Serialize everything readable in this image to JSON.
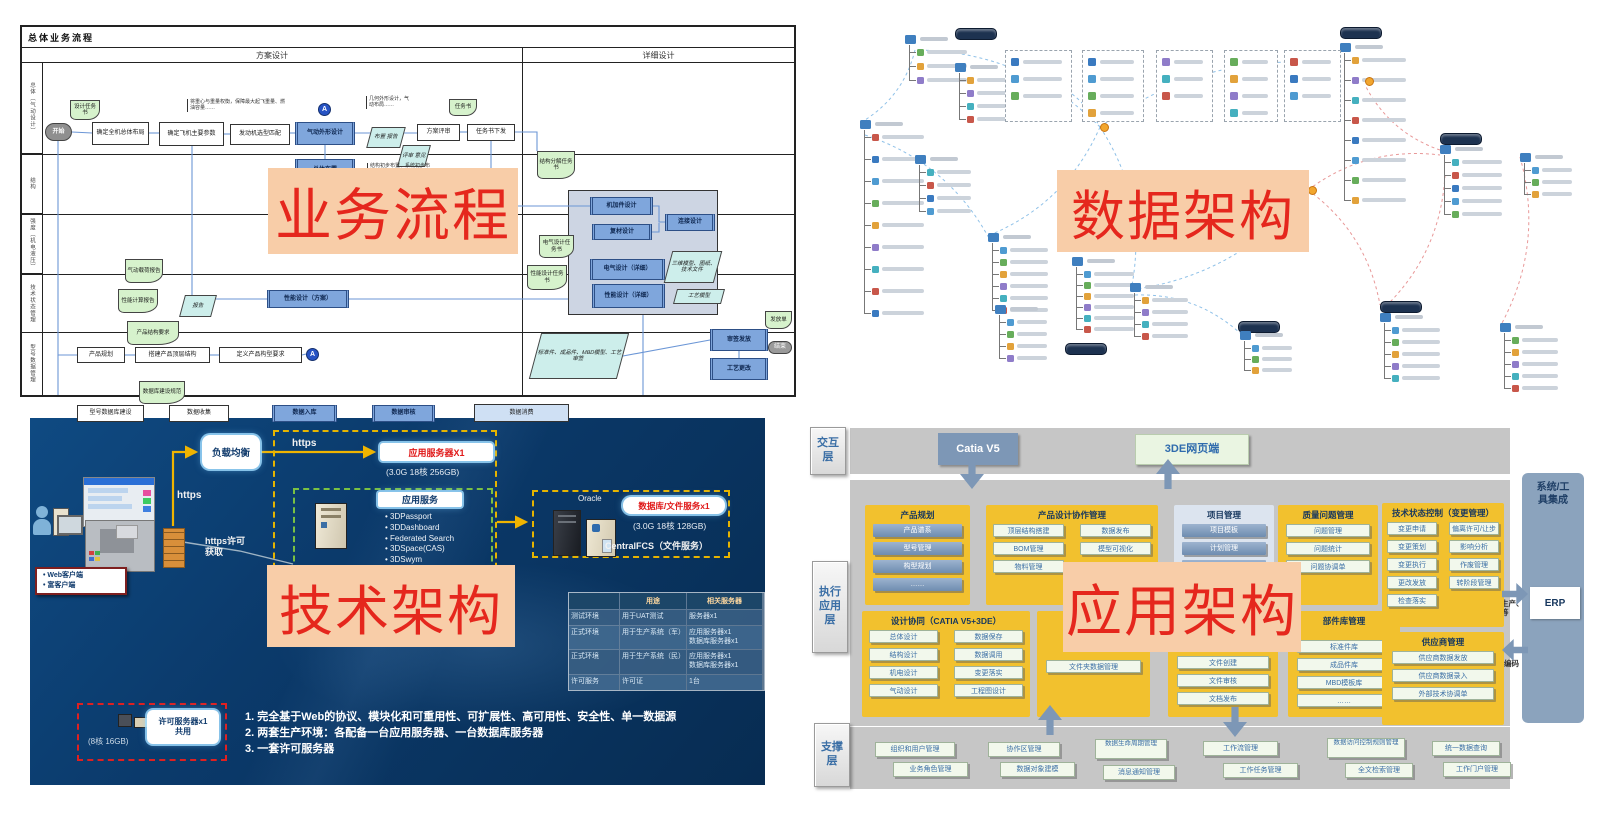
{
  "overlays": [
    {
      "id": "business-process",
      "label": "业务流程",
      "x": 268,
      "y": 168,
      "w": 250,
      "h": 86,
      "fs": 57
    },
    {
      "id": "data-architecture",
      "label": "数据架构",
      "x": 1057,
      "y": 170,
      "w": 252,
      "h": 82,
      "fs": 54
    },
    {
      "id": "tech-architecture",
      "label": "技术架构",
      "x": 267,
      "y": 565,
      "w": 248,
      "h": 82,
      "fs": 54
    },
    {
      "id": "app-architecture",
      "label": "应用架构",
      "x": 1063,
      "y": 562,
      "w": 238,
      "h": 90,
      "fs": 56
    }
  ],
  "tl": {
    "title": "总体业务流程",
    "phases": [
      "方案设计",
      "详细设计"
    ],
    "lanes": [
      "总体（气动设计）",
      "结构",
      "强度（机电液压）",
      "技术状态管理",
      "型号数据管理"
    ],
    "lane_heights": [
      91,
      60,
      60,
      58,
      63
    ],
    "nodes": [
      {
        "t": "panel",
        "x": 546,
        "y": 127,
        "w": 150,
        "h": 125,
        "s": ""
      },
      {
        "t": "doc",
        "x": 48,
        "y": 37,
        "w": 30,
        "h": 20,
        "s": "设计任务书"
      },
      {
        "t": "start",
        "x": 23,
        "y": 60,
        "w": 27,
        "h": 18,
        "s": "开始"
      },
      {
        "t": "box",
        "x": 70,
        "y": 59,
        "w": 57,
        "h": 23,
        "s": "确定全机总体布局"
      },
      {
        "t": "box",
        "x": 137,
        "y": 59,
        "w": 65,
        "h": 24,
        "s": "确定飞机主要参数"
      },
      {
        "t": "box",
        "x": 208,
        "y": 61,
        "w": 60,
        "h": 21,
        "s": "发动机选型匹配"
      },
      {
        "t": "blue",
        "x": 273,
        "y": 59,
        "w": 60,
        "h": 23,
        "s": "气动外形设计"
      },
      {
        "t": "circle",
        "x": 296,
        "y": 40,
        "w": 13,
        "h": 13,
        "s": "A"
      },
      {
        "t": "blue",
        "x": 273,
        "y": 96,
        "w": 60,
        "h": 22,
        "s": "总体布置"
      },
      {
        "t": "para",
        "x": 347,
        "y": 64,
        "w": 34,
        "h": 21,
        "s": "布置 报告"
      },
      {
        "t": "doc",
        "x": 427,
        "y": 36,
        "w": 28,
        "h": 17,
        "s": "任务书"
      },
      {
        "t": "box",
        "x": 395,
        "y": 61,
        "w": 43,
        "h": 17,
        "s": "方案评审"
      },
      {
        "t": "box",
        "x": 445,
        "y": 61,
        "w": 48,
        "h": 17,
        "s": "任务书下发"
      },
      {
        "t": "para",
        "x": 378,
        "y": 82,
        "w": 28,
        "h": 22,
        "s": "评审 意见"
      },
      {
        "t": "doc",
        "x": 515,
        "y": 88,
        "w": 38,
        "h": 28,
        "s": "结构分解任务书"
      },
      {
        "t": "blue",
        "x": 568,
        "y": 134,
        "w": 63,
        "h": 18,
        "s": "机加件设计"
      },
      {
        "t": "blue",
        "x": 570,
        "y": 161,
        "w": 60,
        "h": 16,
        "s": "复材设计"
      },
      {
        "t": "blue",
        "x": 643,
        "y": 151,
        "w": 50,
        "h": 17,
        "s": "连接设计"
      },
      {
        "t": "blue",
        "x": 568,
        "y": 196,
        "w": 75,
        "h": 21,
        "s": "电气设计（详细）"
      },
      {
        "t": "blue",
        "x": 570,
        "y": 221,
        "w": 73,
        "h": 24,
        "s": "性能设计（详细）"
      },
      {
        "t": "para",
        "x": 646,
        "y": 188,
        "w": 50,
        "h": 32,
        "s": "三维模型、图纸、技术文件"
      },
      {
        "t": "para",
        "x": 653,
        "y": 226,
        "w": 48,
        "h": 15,
        "s": "工艺模型"
      },
      {
        "t": "doc",
        "x": 517,
        "y": 172,
        "w": 35,
        "h": 23,
        "s": "电气设计任务书"
      },
      {
        "t": "doc",
        "x": 505,
        "y": 202,
        "w": 40,
        "h": 25,
        "s": "性能设计任务书"
      },
      {
        "t": "blue",
        "x": 245,
        "y": 227,
        "w": 82,
        "h": 18,
        "s": "性能设计（方案）"
      },
      {
        "t": "doc",
        "x": 103,
        "y": 196,
        "w": 38,
        "h": 24,
        "s": "气动载荷报告"
      },
      {
        "t": "doc",
        "x": 96,
        "y": 226,
        "w": 40,
        "h": 24,
        "s": "性能计算报告"
      },
      {
        "t": "para",
        "x": 160,
        "y": 232,
        "w": 32,
        "h": 22,
        "s": "报告"
      },
      {
        "t": "para",
        "x": 513,
        "y": 270,
        "w": 88,
        "h": 46,
        "s": "标准件、成品件、MBD模型、工艺审签"
      },
      {
        "t": "blue",
        "x": 688,
        "y": 266,
        "w": 58,
        "h": 22,
        "s": "审签发放"
      },
      {
        "t": "blue",
        "x": 688,
        "y": 295,
        "w": 58,
        "h": 22,
        "s": "工艺更改"
      },
      {
        "t": "doc",
        "x": 743,
        "y": 248,
        "w": 27,
        "h": 18,
        "s": "发放单"
      },
      {
        "t": "oval",
        "x": 746,
        "y": 278,
        "w": 24,
        "h": 13,
        "s": "结束"
      },
      {
        "t": "box",
        "x": 55,
        "y": 284,
        "w": 48,
        "h": 16,
        "s": "产品规划"
      },
      {
        "t": "doc",
        "x": 105,
        "y": 258,
        "w": 52,
        "h": 24,
        "s": "产品结构要求"
      },
      {
        "t": "box",
        "x": 113,
        "y": 284,
        "w": 75,
        "h": 16,
        "s": "搭建产品顶层结构"
      },
      {
        "t": "box",
        "x": 197,
        "y": 284,
        "w": 83,
        "h": 16,
        "s": "定义产品构型要求"
      },
      {
        "t": "circle",
        "x": 284,
        "y": 285,
        "w": 13,
        "h": 13,
        "s": "A"
      },
      {
        "t": "box",
        "x": 55,
        "y": 342,
        "w": 67,
        "h": 17,
        "s": "型号数据库建设"
      },
      {
        "t": "doc",
        "x": 117,
        "y": 318,
        "w": 46,
        "h": 23,
        "s": "数据库建设规范"
      },
      {
        "t": "box",
        "x": 147,
        "y": 342,
        "w": 60,
        "h": 17,
        "s": "数据收集"
      },
      {
        "t": "blue",
        "x": 250,
        "y": 342,
        "w": 65,
        "h": 17,
        "s": "数据入库"
      },
      {
        "t": "blue",
        "x": 350,
        "y": 342,
        "w": 63,
        "h": 17,
        "s": "数据审核"
      },
      {
        "t": "wide",
        "x": 452,
        "y": 341,
        "w": 95,
        "h": 18,
        "s": "数据消费"
      }
    ],
    "edges": [
      [
        [
          50,
          69
        ],
        [
          70,
          70
        ]
      ],
      [
        [
          127,
          70
        ],
        [
          137,
          70
        ]
      ],
      [
        [
          202,
          71
        ],
        [
          208,
          71
        ]
      ],
      [
        [
          268,
          70
        ],
        [
          273,
          70
        ]
      ],
      [
        [
          303,
          82
        ],
        [
          303,
          96
        ]
      ],
      [
        [
          333,
          70
        ],
        [
          395,
          70
        ]
      ],
      [
        [
          438,
          69
        ],
        [
          445,
          69
        ]
      ],
      [
        [
          36,
          78
        ],
        [
          36,
          292
        ],
        [
          55,
          292
        ]
      ],
      [
        [
          36,
          292
        ],
        [
          36,
          350
        ],
        [
          55,
          350
        ]
      ],
      [
        [
          170,
          83
        ],
        [
          170,
          236
        ],
        [
          245,
          236
        ]
      ],
      [
        [
          469,
          78
        ],
        [
          469,
          143
        ],
        [
          568,
          143
        ]
      ],
      [
        [
          327,
          236
        ],
        [
          546,
          236
        ]
      ],
      [
        [
          631,
          143
        ],
        [
          637,
          143
        ],
        [
          637,
          159
        ],
        [
          643,
          159
        ]
      ],
      [
        [
          630,
          169
        ],
        [
          637,
          169
        ],
        [
          637,
          160
        ]
      ],
      [
        [
          103,
          292
        ],
        [
          113,
          292
        ]
      ],
      [
        [
          188,
          292
        ],
        [
          197,
          292
        ]
      ],
      [
        [
          280,
          292
        ],
        [
          284,
          291
        ]
      ],
      [
        [
          122,
          350
        ],
        [
          147,
          350
        ]
      ],
      [
        [
          207,
          350
        ],
        [
          250,
          350
        ]
      ],
      [
        [
          315,
          350
        ],
        [
          350,
          350
        ]
      ],
      [
        [
          413,
          350
        ],
        [
          452,
          350
        ]
      ],
      [
        [
          621,
          252
        ],
        [
          621,
          350
        ],
        [
          547,
          350
        ]
      ],
      [
        [
          601,
          293
        ],
        [
          688,
          277
        ]
      ],
      [
        [
          717,
          288
        ],
        [
          717,
          295
        ]
      ],
      [
        [
          493,
          69
        ],
        [
          515,
          69
        ],
        [
          515,
          88
        ]
      ]
    ],
    "annotations": [
      {
        "x": 165,
        "y": 36,
        "w": 95,
        "text": "将重心与重量权衡，保障最大起飞重量、燃油容量……"
      },
      {
        "x": 344,
        "y": 33,
        "w": 42,
        "text": "几何外形设计，气动布局……"
      },
      {
        "x": 345,
        "y": 100,
        "w": 60,
        "text": "结构初步布置、系统初步布置……"
      }
    ]
  },
  "tr": {
    "badges": [
      [
        135,
        23
      ],
      [
        520,
        22
      ],
      [
        620,
        128
      ],
      [
        560,
        296
      ],
      [
        418,
        316
      ],
      [
        245,
        338
      ]
    ],
    "clusters": [
      [
        85,
        30,
        3,
        14,
        40
      ],
      [
        135,
        58,
        4,
        13,
        36
      ],
      [
        40,
        115,
        9,
        22,
        42
      ],
      [
        95,
        150,
        4,
        13,
        34
      ],
      [
        168,
        228,
        6,
        12,
        38
      ],
      [
        252,
        252,
        6,
        11,
        40
      ],
      [
        175,
        300,
        4,
        12,
        30
      ],
      [
        310,
        278,
        4,
        12,
        36
      ],
      [
        520,
        38,
        8,
        20,
        44
      ],
      [
        620,
        140,
        5,
        13,
        40
      ],
      [
        700,
        148,
        3,
        12,
        30
      ],
      [
        560,
        308,
        5,
        12,
        38
      ],
      [
        680,
        318,
        5,
        12,
        36
      ],
      [
        420,
        326,
        3,
        11,
        30
      ]
    ],
    "boxes": [
      [
        185,
        45,
        65,
        70,
        3
      ],
      [
        262,
        45,
        60,
        70,
        4
      ],
      [
        336,
        45,
        55,
        70,
        3
      ],
      [
        404,
        45,
        52,
        70,
        4
      ],
      [
        464,
        45,
        55,
        70,
        3
      ]
    ],
    "oranges": [
      [
        280,
        118
      ],
      [
        545,
        72
      ],
      [
        488,
        181
      ]
    ],
    "links": [
      [
        95,
        45,
        45,
        115,
        "b"
      ],
      [
        100,
        45,
        280,
        122,
        "b"
      ],
      [
        280,
        122,
        170,
        230,
        "b"
      ],
      [
        280,
        122,
        312,
        280,
        "b"
      ],
      [
        280,
        122,
        520,
        60,
        "b"
      ],
      [
        488,
        185,
        310,
        285,
        "b"
      ],
      [
        488,
        185,
        560,
        300,
        "r"
      ],
      [
        620,
        145,
        545,
        80,
        "r"
      ],
      [
        700,
        152,
        682,
        318,
        "r"
      ],
      [
        625,
        170,
        562,
        305,
        "r"
      ],
      [
        45,
        130,
        170,
        235,
        "b"
      ],
      [
        315,
        290,
        420,
        328,
        "b"
      ],
      [
        215,
        70,
        280,
        122,
        "b"
      ],
      [
        488,
        185,
        620,
        150,
        "r"
      ]
    ]
  },
  "bl": {
    "client_labels": [
      "Web客户端",
      "富客户端"
    ],
    "https_vert": "https",
    "https_horiz": "https",
    "https_license": "https许可\n获取",
    "lb": "负载均衡",
    "app_server_title": "应用服务器X1",
    "app_server_spec": "(3.0G 18核 256GB)",
    "app_svc_title": "应用服务",
    "app_svc_items": [
      "3DPassport",
      "3DDashboard",
      "Federated Search",
      "3DSpace(CAS)",
      "3DSwym",
      "3DComment"
    ],
    "oracle": "Oracle",
    "db_title": "数据库/文件服务x1",
    "db_spec": "(3.0G 18核 128GB)",
    "fcs": "CentralFCS（文件服务）",
    "lic_title": "许可服务器x1\n共用",
    "lic_spec": "(8核 16GB)",
    "table": {
      "headers": [
        "",
        "用途",
        "相关服务器"
      ],
      "rows": [
        [
          "测试环境",
          "用于UAT测试",
          "服务器x1"
        ],
        [
          "正式环境",
          "用于生产系统（军）",
          "应用服务器x1\n数据库服务器x1"
        ],
        [
          "正式环境",
          "用于生产系统（民）",
          "应用服务器x1\n数据库服务器x1"
        ],
        [
          "许可服务",
          "许可证",
          "1台"
        ]
      ]
    },
    "notes": [
      "完全基于Web的协议、模块化和可重用性、可扩展性、高可用性、安全性、单一数据源",
      "两套生产环境：各配备一台应用服务器、一台数据库服务器",
      "一套许可服务器"
    ]
  },
  "br": {
    "layers": [
      {
        "label": "交互层",
        "x": 20,
        "y": 12,
        "w": 36,
        "h": 48
      },
      {
        "label": "执行应用层",
        "x": 22,
        "y": 146,
        "w": 36,
        "h": 92
      },
      {
        "label": "支撑层",
        "x": 24,
        "y": 308,
        "w": 36,
        "h": 64
      }
    ],
    "topbar_items": [
      {
        "label": "Catia V5",
        "style": "blue",
        "x": 148,
        "y": 18,
        "w": 80,
        "h": 32
      },
      {
        "label": "3DE网页端",
        "style": "green",
        "x": 345,
        "y": 19,
        "w": 112,
        "h": 29
      }
    ],
    "groups": [
      {
        "title": "产品规划",
        "style": "blue",
        "x": 75,
        "y": 90,
        "w": 105,
        "h": 100,
        "cols": 1,
        "items": [
          "产品谱系",
          "型号管理",
          "构型规划",
          "……"
        ]
      },
      {
        "title": "产品设计协作管理",
        "style": "green",
        "x": 196,
        "y": 90,
        "w": 172,
        "h": 100,
        "cols": 2,
        "items": [
          "顶层结构搭建",
          "数据发布",
          "BOM管理",
          "模型可视化",
          "物料管理"
        ]
      },
      {
        "title": "项目管理",
        "style": "blue",
        "panel": "light",
        "x": 384,
        "y": 90,
        "w": 100,
        "h": 100,
        "cols": 1,
        "items": [
          "项目模板",
          "计划管理",
          "……"
        ]
      },
      {
        "title": "质量问题管理",
        "style": "green",
        "x": 488,
        "y": 90,
        "w": 100,
        "h": 100,
        "cols": 1,
        "items": [
          "问题管理",
          "问题统计",
          "问题协调单"
        ]
      },
      {
        "title": "技术状态控制（变更管理）",
        "style": "green",
        "x": 592,
        "y": 88,
        "w": 122,
        "h": 124,
        "cols": 2,
        "items": [
          "变更申请",
          "偏离许可/让步",
          "变更策划",
          "影响分析",
          "变更执行",
          "作废管理",
          "更改发放",
          "转阶段管理",
          "检查落实"
        ]
      },
      {
        "title": "设计协同（CATIA V5+3DE）",
        "style": "green",
        "x": 72,
        "y": 196,
        "w": 168,
        "h": 106,
        "cols": 2,
        "items": [
          "总体设计",
          "数据保存",
          "结构设计",
          "数据调用",
          "机电设计",
          "变更落实",
          "气动设计",
          "工程图设计"
        ]
      },
      {
        "title": "",
        "style": "green",
        "x": 247,
        "y": 196,
        "w": 113,
        "h": 106,
        "cols": 1,
        "pad": 30,
        "items": [
          "文件夹数据管理"
        ]
      },
      {
        "title": "",
        "style": "green",
        "x": 378,
        "y": 196,
        "w": 110,
        "h": 106,
        "cols": 1,
        "pad": 26,
        "items": [
          "文件创建",
          "文件审核",
          "文档发布"
        ]
      },
      {
        "title": "部件库管理",
        "style": "green",
        "x": 498,
        "y": 196,
        "w": 112,
        "h": 106,
        "cols": 1,
        "pad": 10,
        "items": [
          "标准件库",
          "成品件库",
          "MBD模板库",
          "……"
        ]
      },
      {
        "title": "供应商管理",
        "style": "green",
        "x": 592,
        "y": 217,
        "w": 122,
        "h": 93,
        "cols": 1,
        "items": [
          "供应商数据发放",
          "供应商数据录入",
          "外部技术协调单"
        ]
      }
    ],
    "support_items": [
      {
        "label": "组织和用户管理",
        "x": 85,
        "y": 327,
        "w": 80
      },
      {
        "label": "业务角色管理",
        "x": 103,
        "y": 347,
        "w": 75
      },
      {
        "label": "协作区管理",
        "x": 198,
        "y": 327,
        "w": 72
      },
      {
        "label": "数据对象建模",
        "x": 210,
        "y": 347,
        "w": 75
      },
      {
        "label": "数据生命周期管理",
        "x": 305,
        "y": 324,
        "w": 72,
        "wrap": true
      },
      {
        "label": "消息通知管理",
        "x": 313,
        "y": 350,
        "w": 72
      },
      {
        "label": "工作流管理",
        "x": 413,
        "y": 326,
        "w": 75
      },
      {
        "label": "工作任务管理",
        "x": 433,
        "y": 348,
        "w": 75
      },
      {
        "label": "数据访问控制规则管理",
        "x": 537,
        "y": 323,
        "w": 78,
        "wrap": true
      },
      {
        "label": "全文检索管理",
        "x": 555,
        "y": 348,
        "w": 68
      },
      {
        "label": "统一数据查询",
        "x": 642,
        "y": 326,
        "w": 68
      },
      {
        "label": "工作门户管理",
        "x": 653,
        "y": 347,
        "w": 68
      }
    ],
    "arrows": [
      {
        "x": 170,
        "y": 44,
        "d": "down"
      },
      {
        "x": 366,
        "y": 44,
        "d": "up"
      },
      {
        "x": 248,
        "y": 290,
        "d": "up"
      },
      {
        "x": 433,
        "y": 292,
        "d": "down"
      },
      {
        "x": 712,
        "y": 168,
        "d": "right"
      },
      {
        "x": 712,
        "y": 224,
        "d": "left"
      }
    ],
    "integration_title": "系统/工\n具集成",
    "erp": "ERP",
    "arrow_label_out": "支撑生产、\n采购等",
    "arrow_label_in": "编码"
  }
}
